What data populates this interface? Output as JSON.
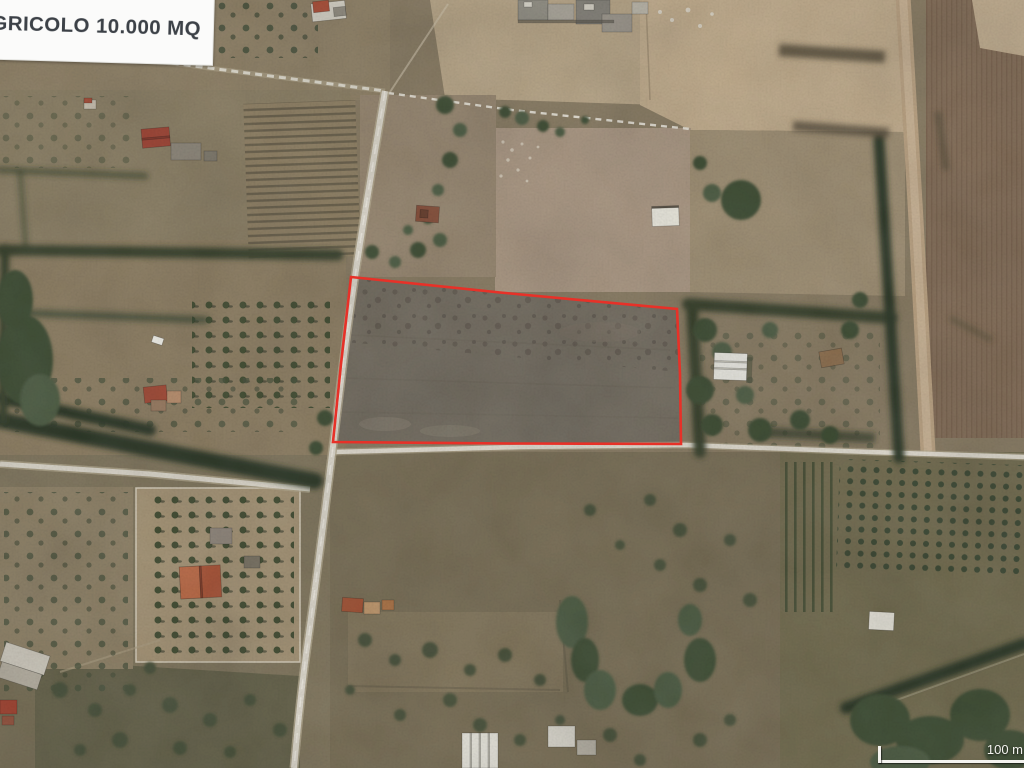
{
  "overlay": {
    "parcel_label": "AGRICOLO 10.000 MQ",
    "scale_label": "100 m"
  },
  "colors": {
    "parcel_outline": "#e73128",
    "label_text": "#3c4147",
    "scale_text": "#f4f3ef"
  }
}
